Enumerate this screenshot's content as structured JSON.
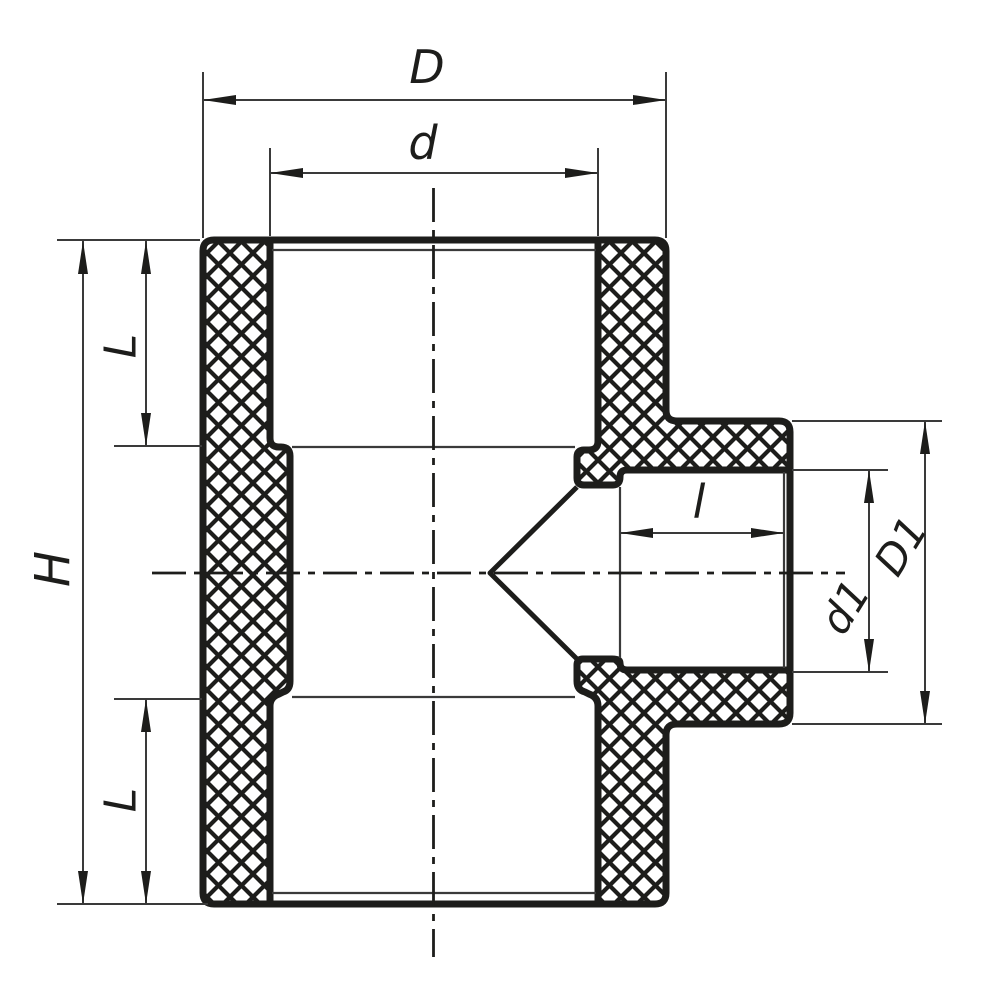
{
  "drawing": {
    "colors": {
      "line": "#1d1d1b",
      "thin_line": "#3a3a3a",
      "background": "#ffffff"
    },
    "labels": {
      "D": "D",
      "d": "d",
      "H": "H",
      "L_top": "L",
      "L_bottom": "L",
      "l": "l",
      "d1": "d1",
      "D1": "D1"
    }
  }
}
